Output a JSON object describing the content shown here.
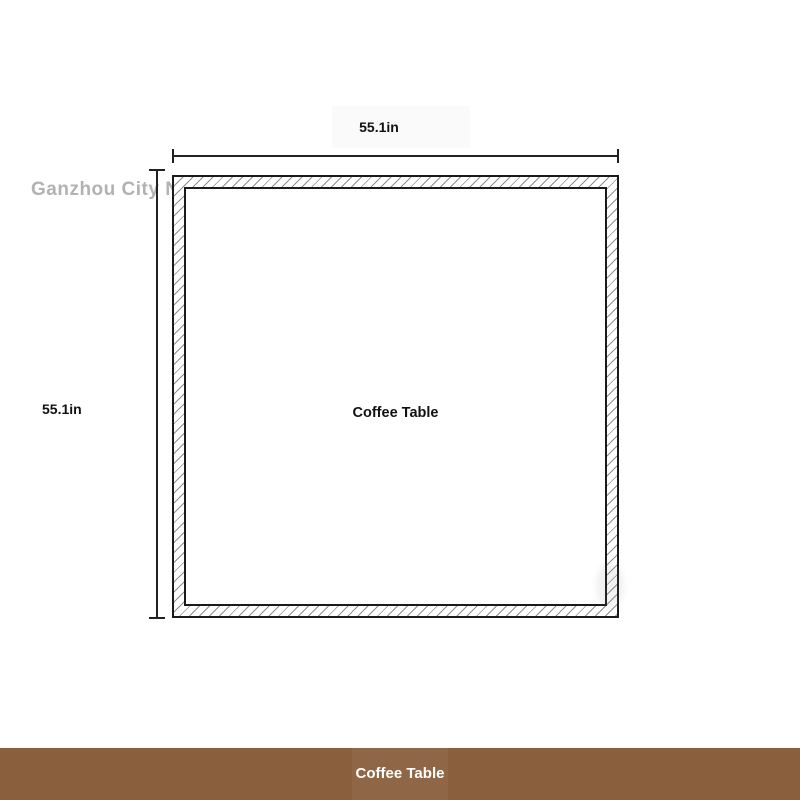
{
  "watermark": {
    "english": "Ganzhou City No",
    "chinese": "桃丁家具有限公司"
  },
  "diagram": {
    "top_dimension": "55.1in",
    "side_dimension": "55.1in",
    "item_label": "Coffee Table"
  },
  "footer": {
    "title": "Coffee Table"
  },
  "colors": {
    "footer_background": "#8a5f3e",
    "footer_text": "#ffffff",
    "outline": "#1a1a1a",
    "hatch_line": "#8f8f8f",
    "watermark_gray": "#b2b2b2"
  }
}
